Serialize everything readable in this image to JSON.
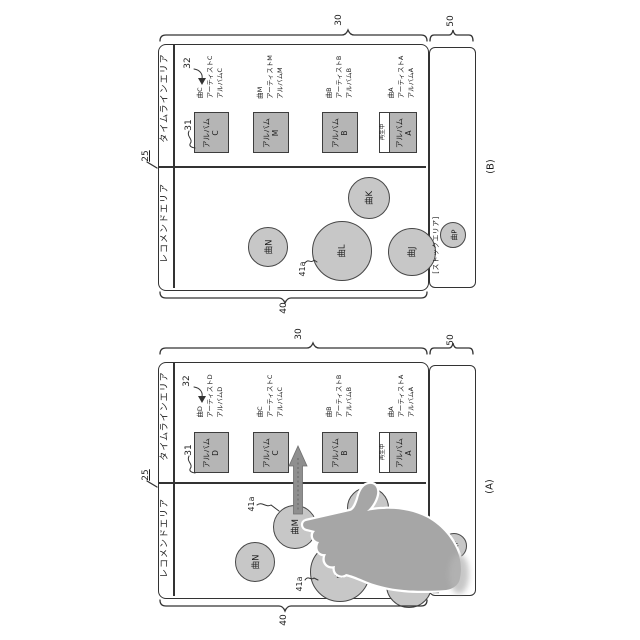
{
  "panel_b": {
    "caption": "(B)",
    "refs": {
      "r25": "25",
      "r30": "30",
      "r31": "31",
      "r32": "32",
      "r40": "40",
      "r41a": "41a",
      "r50": "50"
    },
    "areas": {
      "timeline": "タイムラインエリア",
      "recommend": "レコメンドエリア",
      "stock": "[ストックエリア]"
    },
    "playing_badge": "再生中",
    "albums": [
      {
        "label": "アルバム\nC",
        "song": "曲C\nアーティストC\nアルバムC"
      },
      {
        "label": "アルバム\nM",
        "song": "曲M\nアーティストM\nアルバムM"
      },
      {
        "label": "アルバム\nB",
        "song": "曲B\nアーティストB\nアルバムB"
      },
      {
        "label": "アルバム\nA",
        "song": "曲A\nアーティストA\nアルバムA"
      }
    ],
    "circles": {
      "n": "曲N",
      "l": "曲L",
      "k": "曲K",
      "j": "曲J",
      "p": "曲P"
    }
  },
  "panel_a": {
    "caption": "(A)",
    "refs": {
      "r25": "25",
      "r30": "30",
      "r31": "31",
      "r32": "32",
      "r40": "40",
      "r41a": "41a",
      "r50": "50"
    },
    "areas": {
      "timeline": "タイムラインエリア",
      "recommend": "レコメンドエリア",
      "stock": "[ストックエリア]"
    },
    "playing_badge": "再生中",
    "albums": [
      {
        "label": "アルバム\nD",
        "song": "曲D\nアーティストD\nアルバムD"
      },
      {
        "label": "アルバム\nC",
        "song": "曲C\nアーティストC\nアルバムC"
      },
      {
        "label": "アルバム\nB",
        "song": "曲B\nアーティストB\nアルバムB"
      },
      {
        "label": "アルバム\nA",
        "song": "曲A\nアーティストA\nアルバムA"
      }
    ],
    "circles": {
      "n": "曲N",
      "m": "曲M",
      "l": "曲L",
      "k": "曲K",
      "j": "曲J",
      "p": "曲P"
    }
  },
  "colors": {
    "line": "#333333",
    "album_fill": "#b5b5b5",
    "circle_fill": "#c7c7c7",
    "arrow_fill": "#8f8f8f",
    "hand_fill": "#a6a6a6"
  }
}
